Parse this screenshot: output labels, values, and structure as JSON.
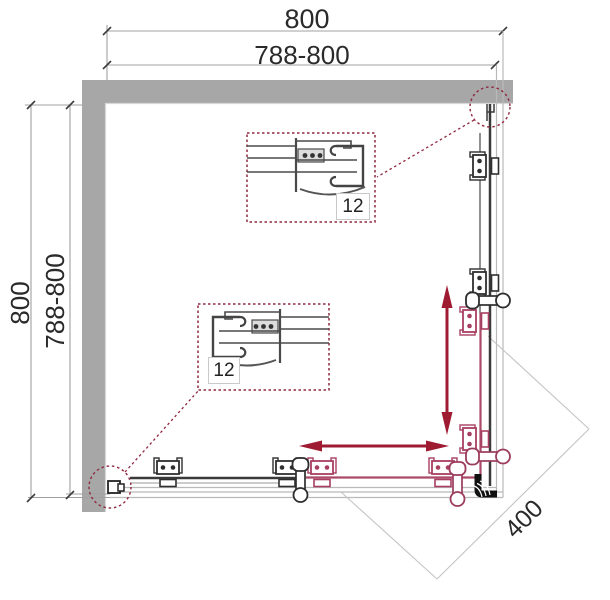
{
  "diagram": {
    "type": "shower-enclosure-plan-view",
    "dims": {
      "width_total": "800",
      "width_range": "788-800",
      "height_total": "800",
      "height_range": "788-800",
      "door_width": "400",
      "detail_top_thickness": "12",
      "detail_bottom_thickness": "12"
    },
    "colors": {
      "wall": "#a7a7a7",
      "outline_dark": "#3a3a3a",
      "profile_thin": "#b9b9b9",
      "dim_line": "#a0a0a0",
      "arrow_accent": "#9e1b32",
      "door_accent": "#aa4a68",
      "clamp_accent": "#a83f60",
      "callout": "#8f2840"
    }
  }
}
